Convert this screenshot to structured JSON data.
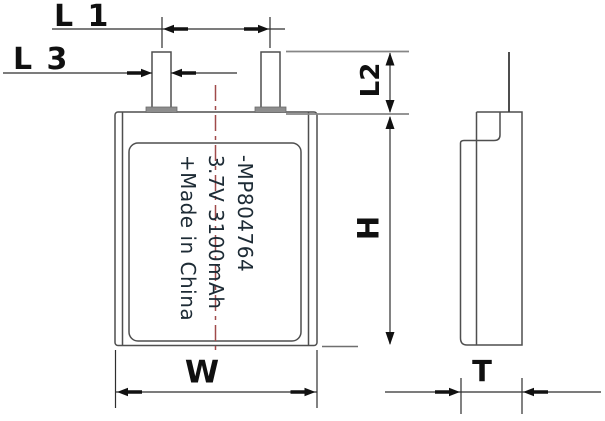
{
  "front_view": {
    "model": "-MP804764",
    "rating": "3.7V 3100mAh",
    "origin": "+Made in China"
  },
  "dimensions": {
    "l1": "L 1",
    "l3": "L 3",
    "l2": "L2",
    "h": "H",
    "w": "W",
    "t": "T"
  },
  "colors": {
    "linework": "#4f4f4f",
    "centerline": "#a04a4a",
    "label_text": "#101010",
    "cell_text": "#1d2b35"
  }
}
